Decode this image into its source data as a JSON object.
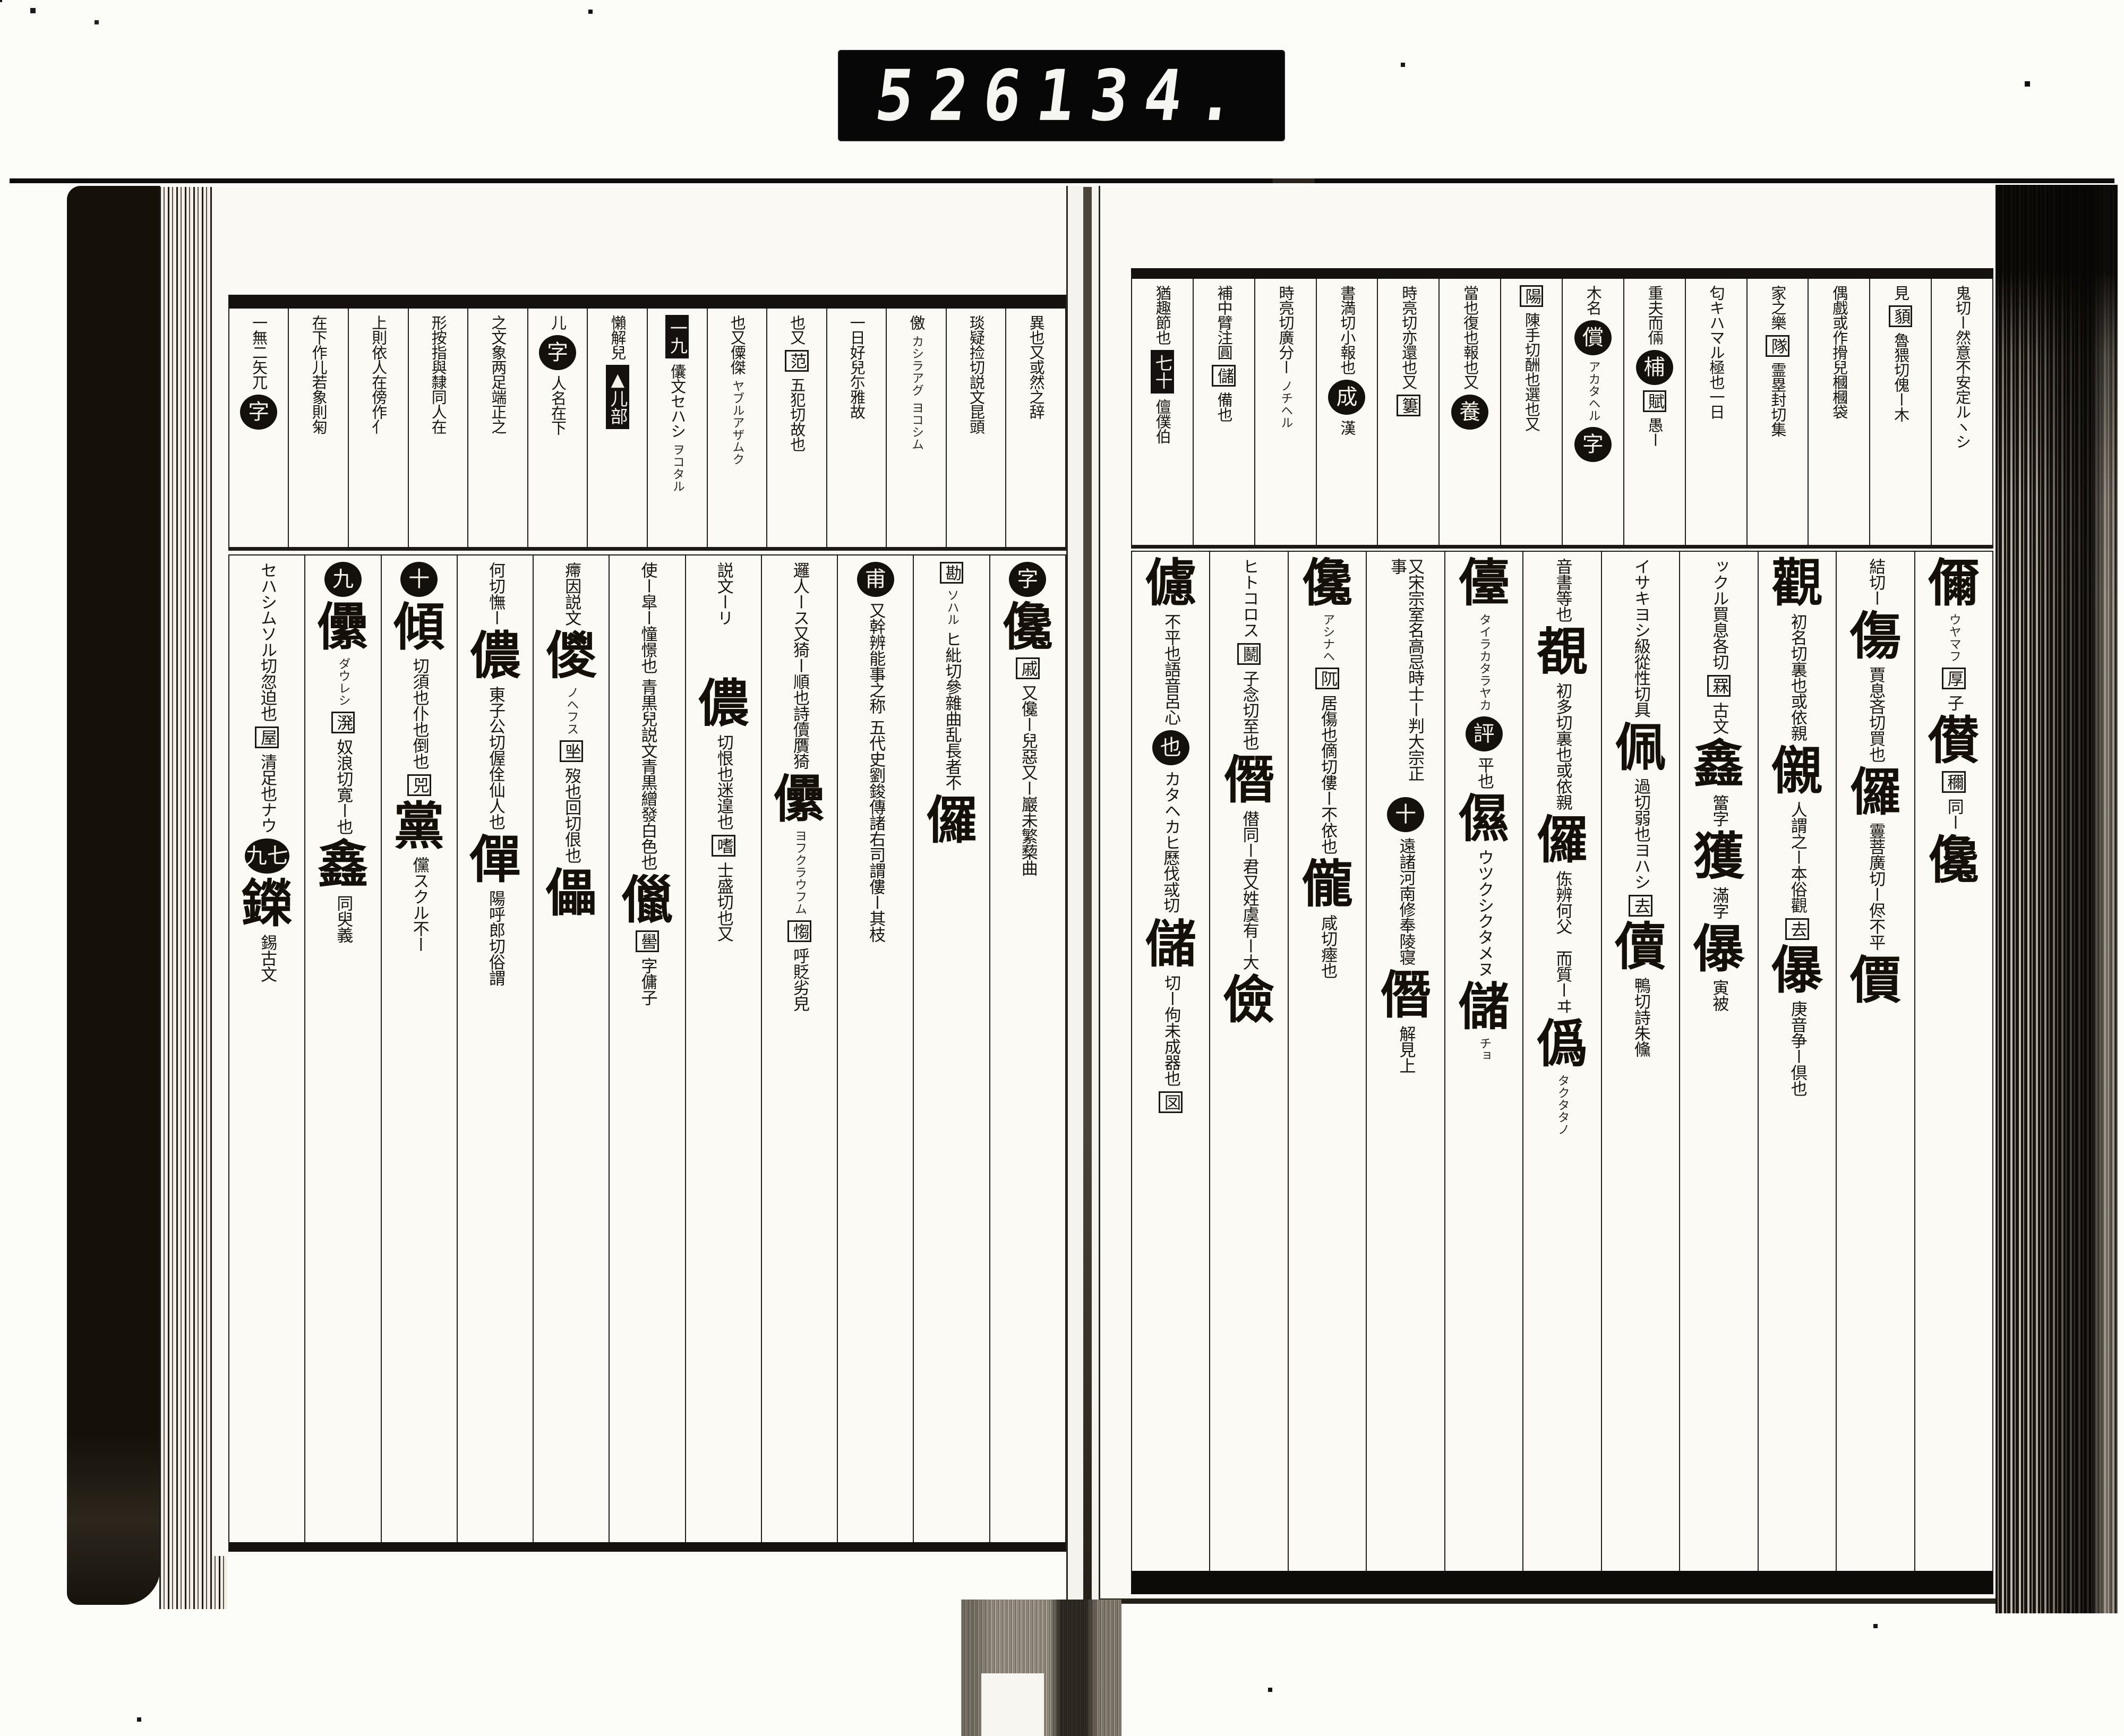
{
  "counter": {
    "left": "526",
    "right": "134."
  },
  "colors": {
    "ink": "#16120e",
    "paper": "#faf9f3",
    "background": "#fcfcf9",
    "counter_bg": "#070707",
    "counter_digits": "#f5f5f2"
  },
  "book": {
    "left_page": {
      "header_columns": [
        [
          [
            "s",
            "異也又或然之辞"
          ]
        ],
        [
          [
            "s",
            "琰疑捡切説文昆頭"
          ]
        ],
        [
          [
            "s",
            "儌"
          ],
          [
            "g",
            "カシラアグ"
          ],
          [
            "g",
            "ヨコシム"
          ]
        ],
        [
          [
            "s",
            "一日好兒尓雅故"
          ]
        ],
        [
          [
            "s",
            "也又"
          ],
          [
            "b",
            "范"
          ],
          [
            "s",
            "五犯切故也"
          ]
        ],
        [
          [
            "s",
            "也又僳傑"
          ],
          [
            "g",
            "ヤブルアザムク"
          ]
        ],
        [
          [
            "l",
            "一九"
          ],
          [
            "s",
            "儾文セハシ"
          ],
          [
            "g",
            "ヲコタル"
          ]
        ],
        [
          [
            "s",
            "懶解兒"
          ],
          [
            "l",
            "▲儿部"
          ]
        ],
        [
          [
            "s",
            "儿"
          ],
          [
            "c",
            "字"
          ],
          [
            "s",
            "人名在下"
          ]
        ],
        [
          [
            "s",
            "之文象两足端正之"
          ]
        ],
        [
          [
            "s",
            "形按指與隸同人在"
          ]
        ],
        [
          [
            "s",
            "上則依人在傍作亻"
          ]
        ],
        [
          [
            "s",
            "在下作儿若象則匊"
          ]
        ],
        [
          [
            "s",
            "一無二矢兀"
          ],
          [
            "c",
            "字"
          ]
        ]
      ],
      "body_columns": [
        [
          [
            "c",
            "字"
          ],
          [
            "h",
            "儳"
          ],
          [
            "b",
            "戚"
          ],
          [
            "s",
            "又儳ー兒惡又ー巖未繁蔾曲"
          ]
        ],
        [
          [
            "b",
            "勘"
          ],
          [
            "g",
            "ソハル"
          ],
          [
            "s",
            "ヒ紕切參雜曲乱長者不"
          ],
          [
            "h",
            "儸"
          ]
        ],
        [
          [
            "c",
            "甫"
          ],
          [
            "s",
            "又幹辨能事之称"
          ],
          [
            "s",
            "五代史劉鋑傳諸右司謂僂ー其枝"
          ]
        ],
        [
          [
            "s",
            "邏人ース又猗ー順也詩儥贋猗"
          ],
          [
            "h",
            "儽"
          ],
          [
            "g",
            "ヨフクラウフム"
          ],
          [
            "b",
            "㥮"
          ],
          [
            "s",
            "呼貶劣皃"
          ]
        ],
        [
          [
            "s",
            "説文ーリ𠫤不齊"
          ],
          [
            "h",
            "儂"
          ],
          [
            "s",
            "切恨也迷遑也"
          ],
          [
            "b",
            "嗜"
          ],
          [
            "s",
            "士盛切也又"
          ]
        ],
        [
          [
            "s",
            "使ー皐ー憧憬也"
          ],
          [
            "s",
            "青黒兒説文青黒繒發白色也"
          ],
          [
            "h",
            "儠"
          ],
          [
            "b",
            "嚳"
          ],
          [
            "s",
            "字傭子"
          ]
        ],
        [
          [
            "s",
            "㿃因説文"
          ],
          [
            "h",
            "儍"
          ],
          [
            "g",
            "ノヘフス"
          ],
          [
            "b",
            "㘴"
          ],
          [
            "s",
            "歿也回切佷也"
          ],
          [
            "h",
            "儡"
          ]
        ],
        [
          [
            "s",
            "何切憮ー"
          ],
          [
            "h",
            "儂"
          ],
          [
            "s",
            "東子公切偓佺仙人也"
          ],
          [
            "h",
            "僤"
          ],
          [
            "s",
            "陽呼郎切俗謂"
          ]
        ],
        [
          [
            "c",
            "十"
          ],
          [
            "h",
            "傾"
          ],
          [
            "s",
            "切須也仆也倒也"
          ],
          [
            "b",
            "兕"
          ],
          [
            "h",
            "黨"
          ],
          [
            "s",
            "儻スクル不ー"
          ]
        ],
        [
          [
            "c",
            "九"
          ],
          [
            "h",
            "儽"
          ],
          [
            "g",
            "ダウレシ"
          ],
          [
            "b",
            "溌"
          ],
          [
            "s",
            "奴浪切寛ー也"
          ],
          [
            "h",
            "鑫"
          ],
          [
            "s",
            "同臾義"
          ]
        ],
        [
          [
            "s",
            "セハシムソル切忽迫也"
          ],
          [
            "b",
            "屋"
          ],
          [
            "s",
            "清足也ナウ"
          ],
          [
            "c",
            "九七"
          ],
          [
            "h",
            "鑅"
          ],
          [
            "s",
            "錫古文"
          ]
        ]
      ]
    },
    "right_page": {
      "header_columns": [
        [
          [
            "s",
            "鬼切ー然意不安定ルヽシ"
          ]
        ],
        [
          [
            "s",
            "見"
          ],
          [
            "b",
            "䫉"
          ],
          [
            "s",
            "魯猥切傀ー木"
          ]
        ],
        [
          [
            "s",
            "偶戲或作搰兒槶槶袋"
          ]
        ],
        [
          [
            "s",
            "家之樂"
          ],
          [
            "b",
            "隊"
          ],
          [
            "s",
            "霊塁封切集"
          ]
        ],
        [
          [
            "s",
            "匂キハマル極也一日"
          ]
        ],
        [
          [
            "s",
            "重夫而倆"
          ],
          [
            "c",
            "㭪"
          ],
          [
            "b",
            "賦"
          ],
          [
            "s",
            "愚ー"
          ]
        ],
        [
          [
            "s",
            "木名"
          ],
          [
            "c",
            "償"
          ],
          [
            "g",
            "アカタヘル"
          ],
          [
            "c",
            "字"
          ]
        ],
        [
          [
            "b",
            "陽"
          ],
          [
            "s",
            "陳手切酬也選也又"
          ]
        ],
        [
          [
            "s",
            "當也復也報也又"
          ],
          [
            "c",
            "養"
          ]
        ],
        [
          [
            "s",
            "時亮切亦還也又"
          ],
          [
            "b",
            "簍"
          ]
        ],
        [
          [
            "s",
            "書満切小報也"
          ],
          [
            "c",
            "成"
          ],
          [
            "s",
            "漢"
          ]
        ],
        [
          [
            "s",
            "時亮切廣分ー"
          ],
          [
            "g",
            "ノチヘル"
          ]
        ],
        [
          [
            "s",
            "補中臂注圓"
          ],
          [
            "b",
            "儲"
          ],
          [
            "s",
            "備也"
          ]
        ],
        [
          [
            "s",
            "猶趣節也"
          ],
          [
            "l",
            "七十"
          ],
          [
            "s",
            "儃僕伯"
          ]
        ]
      ],
      "body_columns": [
        [
          [
            "h",
            "儞"
          ],
          [
            "g",
            "ウヤマフ"
          ],
          [
            "b",
            "厚"
          ],
          [
            "s",
            "子"
          ],
          [
            "h",
            "儧"
          ],
          [
            "b",
            "穪"
          ],
          [
            "s",
            "同ー"
          ],
          [
            "h",
            "儳"
          ]
        ],
        [
          [
            "s",
            "結切ー"
          ],
          [
            "h",
            "傷"
          ],
          [
            "s",
            "賈息吝切買也"
          ],
          [
            "h",
            "儸"
          ],
          [
            "s",
            "霻菩廣切ー侭不平"
          ],
          [
            "h",
            "價"
          ]
        ],
        [
          [
            "h",
            "觀"
          ],
          [
            "s",
            "初名切裏也或依親"
          ],
          [
            "h",
            "儭"
          ],
          [
            "s",
            "人謂之ー本俗觀"
          ],
          [
            "b",
            "去"
          ],
          [
            "h",
            "儤"
          ],
          [
            "s",
            "庚音争ー倶也"
          ]
        ],
        [
          [
            "s",
            "ックル買息各切"
          ],
          [
            "b",
            "罧"
          ],
          [
            "s",
            "古文"
          ],
          [
            "h",
            "鑫"
          ],
          [
            "s",
            "簹字"
          ],
          [
            "h",
            "獲"
          ],
          [
            "s",
            "滿字"
          ],
          [
            "h",
            "儤"
          ],
          [
            "s",
            "寅被"
          ]
        ],
        [
          [
            "s",
            "イサキヨシ級從性切具"
          ],
          [
            "h",
            "佩"
          ],
          [
            "s",
            "過切弱也ヨハシ"
          ],
          [
            "b",
            "去"
          ],
          [
            "h",
            "儥"
          ],
          [
            "s",
            "鴨切詩朱儵"
          ]
        ],
        [
          [
            "s",
            "音書等也"
          ],
          [
            "h",
            "覩"
          ],
          [
            "s",
            "初多切裏也或依親"
          ],
          [
            "h",
            "儸"
          ],
          [
            "s",
            "㑈辨何父𢋫而質ーヰ"
          ],
          [
            "h",
            "僞"
          ],
          [
            "g",
            "タクタタノ"
          ]
        ],
        [
          [
            "h",
            "儓"
          ],
          [
            "g",
            "タイラカタラヤカ"
          ],
          [
            "c",
            "評"
          ],
          [
            "s",
            "平也"
          ],
          [
            "h",
            "儑"
          ],
          [
            "s",
            "ウツクシクタメヌ"
          ],
          [
            "h",
            "儲"
          ],
          [
            "g",
            "チョ"
          ]
        ],
        [
          [
            "s",
            "又宋宗室名高忌時士ー判大宗正事"
          ],
          [
            "c",
            "十"
          ],
          [
            "s",
            "遠諸河南修奉陵寝"
          ],
          [
            "h",
            "僭"
          ],
          [
            "s",
            "解見上"
          ]
        ],
        [
          [
            "h",
            "儳"
          ],
          [
            "g",
            "アシナヘ"
          ],
          [
            "b",
            "阢"
          ],
          [
            "s",
            "居傷也㒀切僂ー不依也"
          ],
          [
            "h",
            "儱"
          ],
          [
            "s",
            "咸切瘞也"
          ]
        ],
        [
          [
            "s",
            "ヒトコロス"
          ],
          [
            "b",
            "鬭"
          ],
          [
            "s",
            "子念切至也"
          ],
          [
            "h",
            "僭"
          ],
          [
            "s",
            "僣同ー君又姓虞有ー大"
          ],
          [
            "h",
            "儉"
          ]
        ],
        [
          [
            "h",
            "儢"
          ],
          [
            "s",
            "不平也語音呂心"
          ],
          [
            "c",
            "也"
          ],
          [
            "s",
            "カタヘカヒ𠪾伐㦯切"
          ],
          [
            "h",
            "儲"
          ],
          [
            "s",
            "切ー佝未成器也"
          ],
          [
            "b",
            "㘝"
          ]
        ]
      ]
    }
  }
}
